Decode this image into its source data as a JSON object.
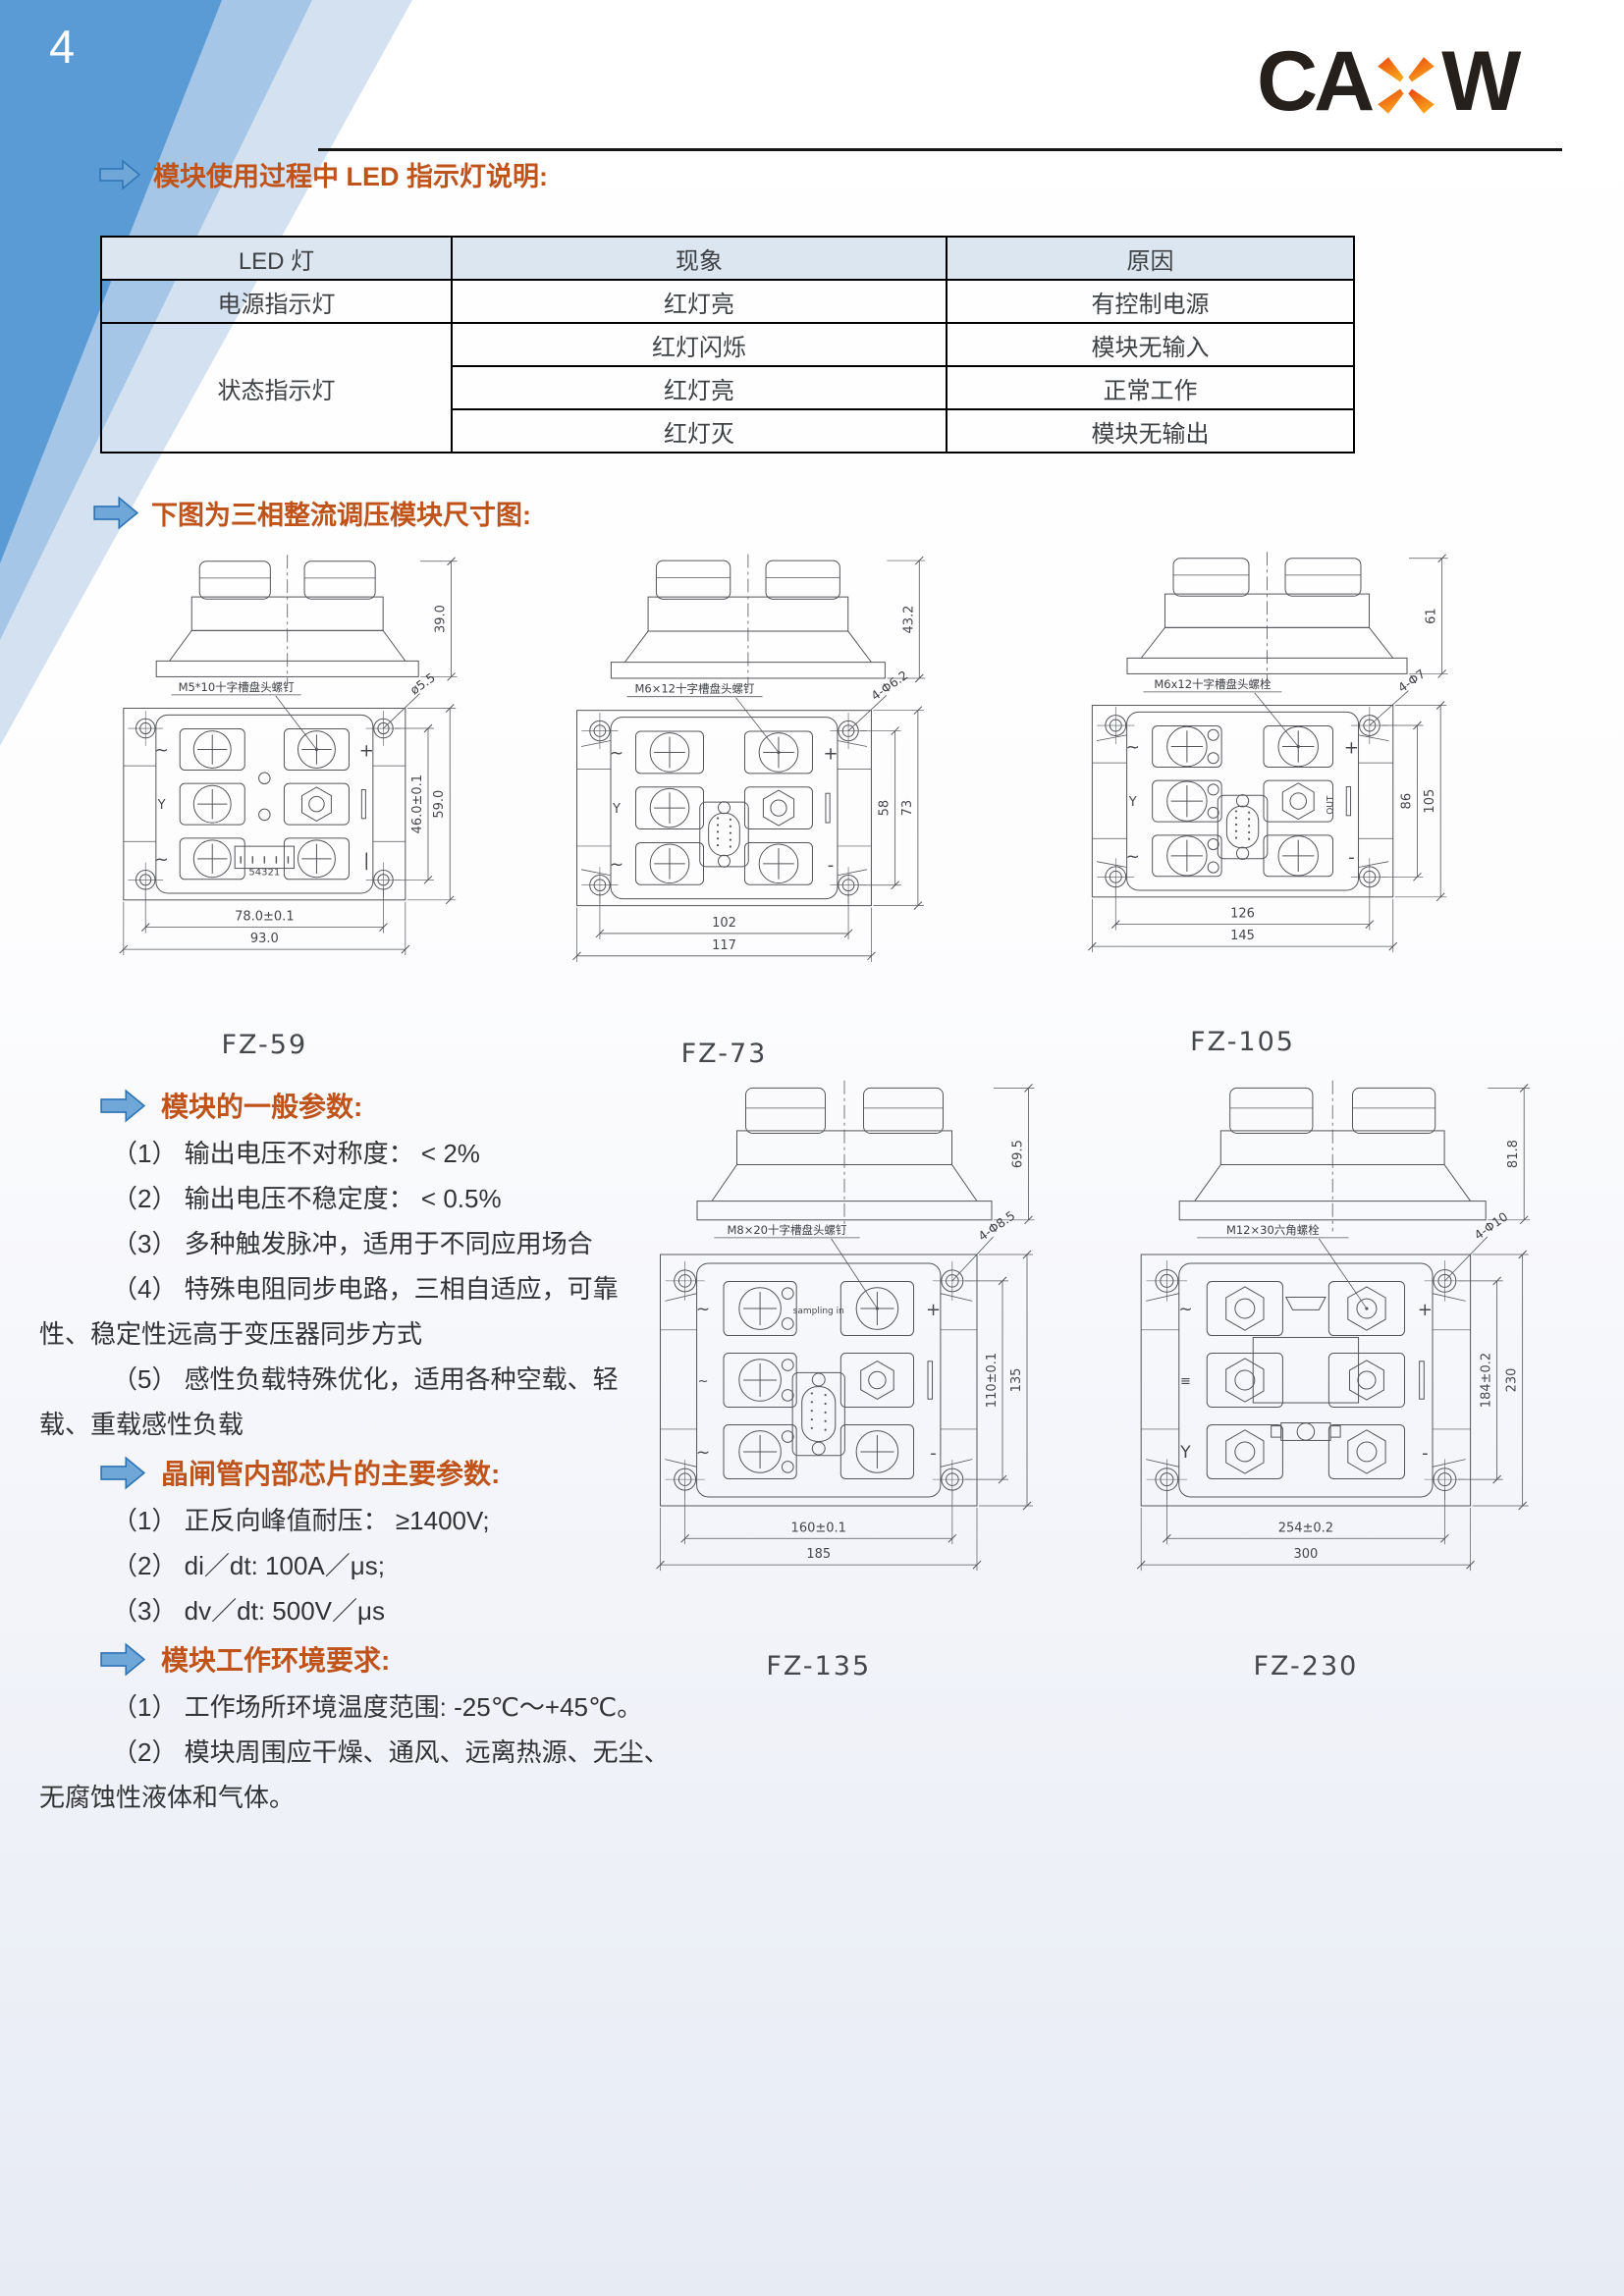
{
  "page": {
    "number": "4",
    "logo": {
      "part1": "CA",
      "part2": "W",
      "letter_color": "#26201c",
      "x_color_top": "#e8430d",
      "x_color_bottom": "#f9a31d"
    },
    "accent_blue": "#5b9bd5",
    "heading_color": "#c0531a",
    "table_header_bg": "#dce6f1"
  },
  "headings": {
    "led_section": "模块使用过程中 LED 指示灯说明:",
    "dims_section": "下图为三相整流调压模块尺寸图:",
    "general_params": "模块的一般参数:",
    "thyristor_params": "晶闸管内部芯片的主要参数:",
    "environment": "模块工作环境要求:"
  },
  "led_table": {
    "headers": [
      "LED 灯",
      "现象",
      "原因"
    ],
    "rows": [
      {
        "led": "电源指示灯",
        "items": [
          {
            "phenomenon": "红灯亮",
            "reason": "有控制电源"
          }
        ]
      },
      {
        "led": "状态指示灯",
        "items": [
          {
            "phenomenon": "红灯闪烁",
            "reason": "模块无输入"
          },
          {
            "phenomenon": "红灯亮",
            "reason": "正常工作"
          },
          {
            "phenomenon": "红灯灭",
            "reason": "模块无输出"
          }
        ]
      }
    ]
  },
  "params": {
    "general": [
      "（1） 输出电压不对称度： < 2%",
      "（2） 输出电压不稳定度： < 0.5%",
      "（3） 多种触发脉冲，适用于不同应用场合",
      "（4） 特殊电阻同步电路，三相自适应，可靠",
      "性、稳定性远高于变压器同步方式",
      "（5） 感性负载特殊优化，适用各种空载、轻",
      "载、重载感性负载"
    ],
    "thyristor": [
      "（1） 正反向峰值耐压： ≥1400V;",
      "（2） di／dt:  100A／μs;",
      "（3） dv／dt:  500V／μs"
    ],
    "environment": [
      "（1） 工作场所环境温度范围:  -25℃～+45℃。",
      "（2） 模块周围应干燥、通风、远离热源、无尘、",
      "无腐蚀性液体和气体。"
    ]
  },
  "modules": [
    {
      "name": "FZ-59",
      "screw_label": "M5*10十字槽盘头螺钉",
      "hole_label": "ø5.5",
      "side_height": "39.0",
      "right_dims": [
        "46.0±0.1",
        "59.0"
      ],
      "bottom_dims": [
        "78.0±0.1",
        "93.0"
      ],
      "connector": "pins",
      "pin_label": "54321",
      "phase_marks": [
        "~",
        "Y",
        "~"
      ],
      "polarity": [
        "+",
        "|"
      ],
      "screw_type": "phillips",
      "gussets": false,
      "small_screws": false,
      "big": false,
      "note": "",
      "out_label": ""
    },
    {
      "name": "FZ-73",
      "screw_label": "M6×12十字槽盘头螺钉",
      "hole_label": "4-Φ6.2",
      "side_height": "43.2",
      "right_dims": [
        "58",
        "73"
      ],
      "bottom_dims": [
        "102",
        "117"
      ],
      "connector": "dsub",
      "pin_label": "",
      "phase_marks": [
        "~",
        "Y",
        "~"
      ],
      "polarity": [
        "+",
        "-"
      ],
      "screw_type": "phillips",
      "gussets": true,
      "small_screws": false,
      "big": false,
      "note": "",
      "out_label": ""
    },
    {
      "name": "FZ-105",
      "screw_label": "M6x12十字槽盘头螺栓",
      "hole_label": "4-Φ7",
      "side_height": "61",
      "right_dims": [
        "86",
        "105"
      ],
      "bottom_dims": [
        "126",
        "145"
      ],
      "connector": "dsub",
      "pin_label": "",
      "phase_marks": [
        "~",
        "Y",
        "~"
      ],
      "polarity": [
        "+",
        "-"
      ],
      "screw_type": "phillips",
      "gussets": true,
      "small_screws": true,
      "big": false,
      "note": "",
      "out_label": "OUT"
    },
    {
      "name": "FZ-135",
      "screw_label": "M8×20十字槽盘头螺钉",
      "hole_label": "4-Φ8.5",
      "side_height": "69.5",
      "right_dims": [
        "110±0.1",
        "135"
      ],
      "bottom_dims": [
        "160±0.1",
        "185"
      ],
      "connector": "dsub",
      "pin_label": "",
      "phase_marks": [
        "~",
        "~",
        "~"
      ],
      "polarity": [
        "+",
        "-"
      ],
      "screw_type": "phillips",
      "gussets": true,
      "small_screws": true,
      "big": true,
      "note": "sampling in",
      "out_label": ""
    },
    {
      "name": "FZ-230",
      "screw_label": "M12×30六角螺栓",
      "hole_label": "4-Φ10",
      "side_height": "81.8",
      "right_dims": [
        "184±0.2",
        "230"
      ],
      "bottom_dims": [
        "254±0.2",
        "300"
      ],
      "connector": "bigrect",
      "pin_label": "",
      "phase_marks": [
        "~",
        "≡",
        "Y"
      ],
      "polarity": [
        "+",
        "-"
      ],
      "screw_type": "hex",
      "gussets": true,
      "small_screws": false,
      "big": true,
      "note": "",
      "out_label": ""
    }
  ]
}
